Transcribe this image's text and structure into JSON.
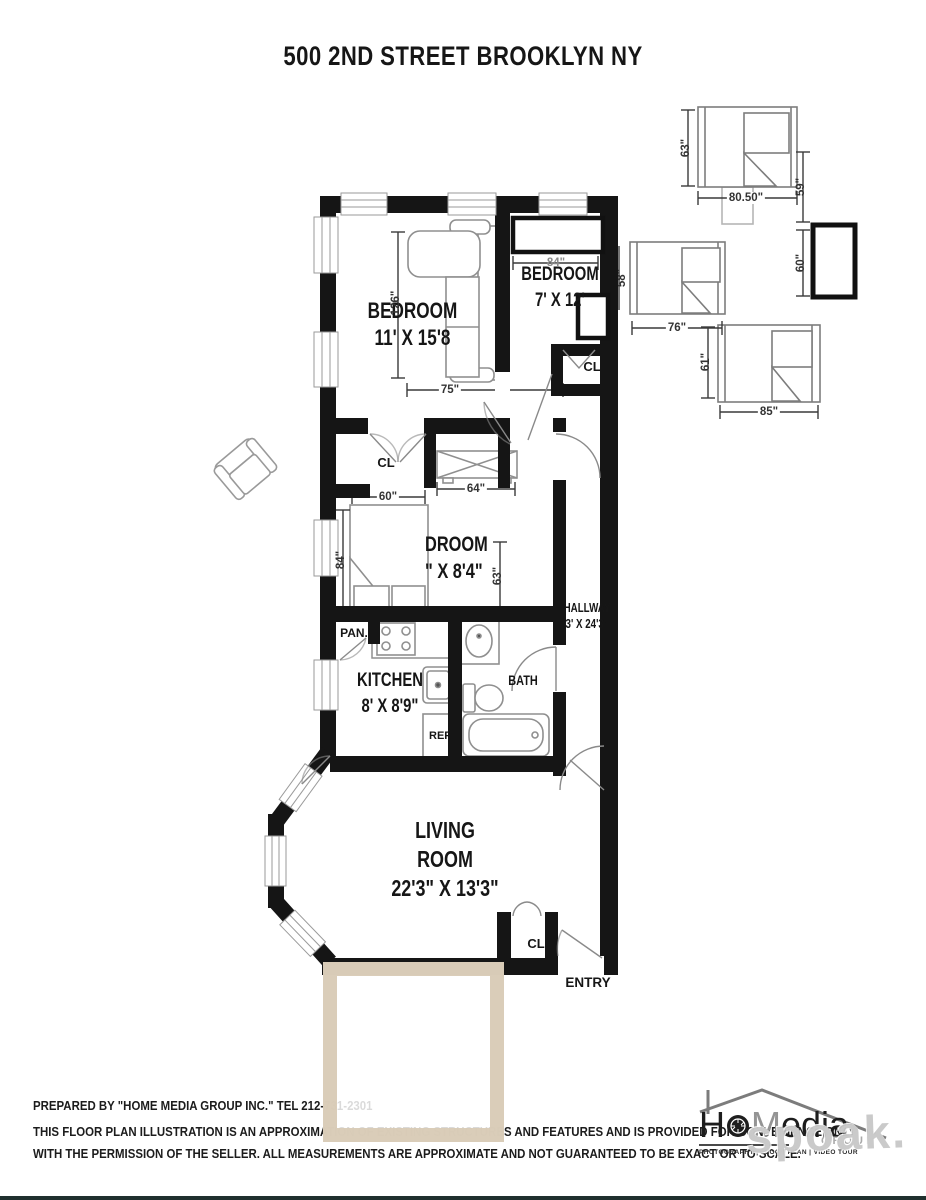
{
  "title": "500 2ND STREET BROOKLYN NY",
  "rooms": {
    "bedroom1": {
      "name": "BEDROOM",
      "dims": "11' X 15'8"
    },
    "bedroom2": {
      "name": "BEDROOM",
      "dims": "7' X 12'"
    },
    "bedroom3": {
      "name_visible": "DROOM",
      "dims_visible": "\" X 8'4\""
    },
    "kitchen": {
      "name": "KITCHEN",
      "dims": "8' X 8'9\""
    },
    "bath": {
      "name": "BATH"
    },
    "hallway": {
      "name": "HALLWAY",
      "dims": "3' X 24'3\""
    },
    "living": {
      "line1": "LIVING",
      "line2": "ROOM",
      "dims": "22'3\" X 13'3\""
    }
  },
  "annotations": {
    "closet": "CL",
    "pantry": "PAN.",
    "fridge": "REF",
    "entry": "ENTRY"
  },
  "dimensions": {
    "bedA_height": "63\"",
    "bedA_width": "80.50\"",
    "gap_right": "59\"",
    "cabinet_height": "60\"",
    "bedB_width": "76\"",
    "bedB_height": "58\"",
    "bedC_height": "61\"",
    "bedC_width": "85\"",
    "bedroom1_length": "126\"",
    "bedroom1_width": "75\"",
    "bedroom2_width": "84\"",
    "bed3_width": "60\"",
    "bed3_length": "84\"",
    "dresser_width": "64\"",
    "closet3_height": "63\""
  },
  "footer": {
    "line1": "PREPARED BY \"HOME MEDIA GROUP INC.\" TEL 212-731-2301",
    "line2": "THIS FLOOR PLAN ILLUSTRATION IS AN APPROXIMATION OF EXISTING STRUCTURES AND FEATURES AND IS PROVIDED FOR CONVENIENCE ONLY",
    "line3": "WITH THE PERMISSION OF THE SELLER. ALL MEASUREMENTS ARE APPROXIMATE AND NOT GUARANTEED TO BE EXACT OR TO SCALE."
  },
  "logo": {
    "brand_h": "H",
    "brand_m": "M",
    "brand_rest": "edia",
    "brand_sub": "GROUP",
    "tagline": "PHOTOGRAPHY | FLOOR PLAN | VIDEO TOUR"
  },
  "watermark": "spoak.",
  "colors": {
    "wall": "#151515",
    "tan_box": "#d8cab5",
    "dim_line": "#3a3a3a",
    "furniture": "#8f8f8f"
  }
}
